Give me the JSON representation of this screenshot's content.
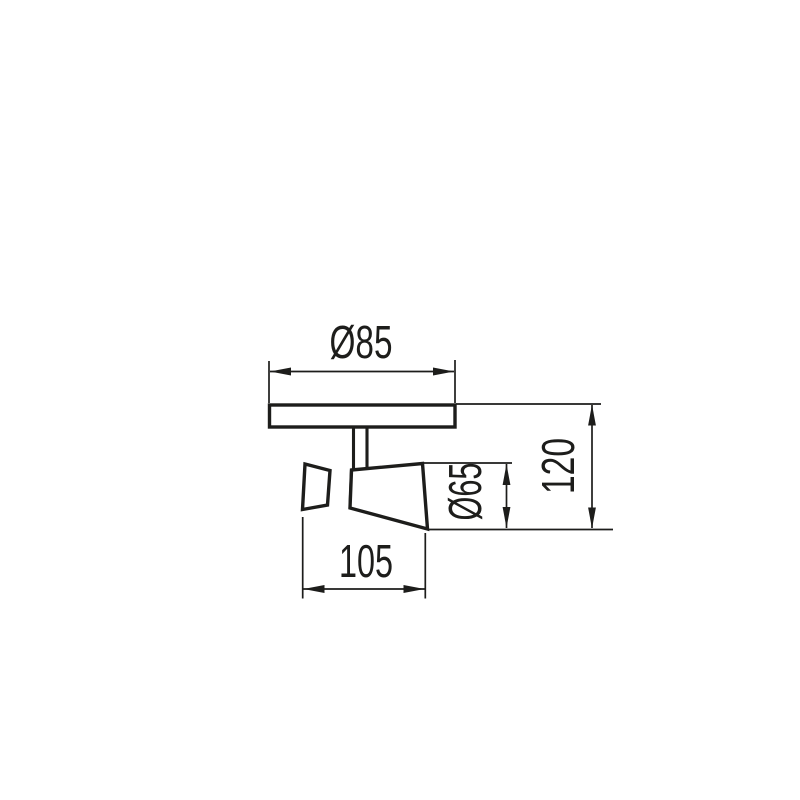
{
  "canvas": {
    "width": 800,
    "height": 800,
    "background": "#ffffff"
  },
  "drawing": {
    "line_color": "#1d1d1b",
    "fill_color": "#ffffff",
    "dimensions": {
      "plate_diameter": {
        "label": "Ø85",
        "value": 85
      },
      "body_length": {
        "label": "105",
        "value": 105
      },
      "head_diameter": {
        "label": "Ø65",
        "value": 65
      },
      "overall_height": {
        "label": "120",
        "value": 120
      }
    }
  }
}
